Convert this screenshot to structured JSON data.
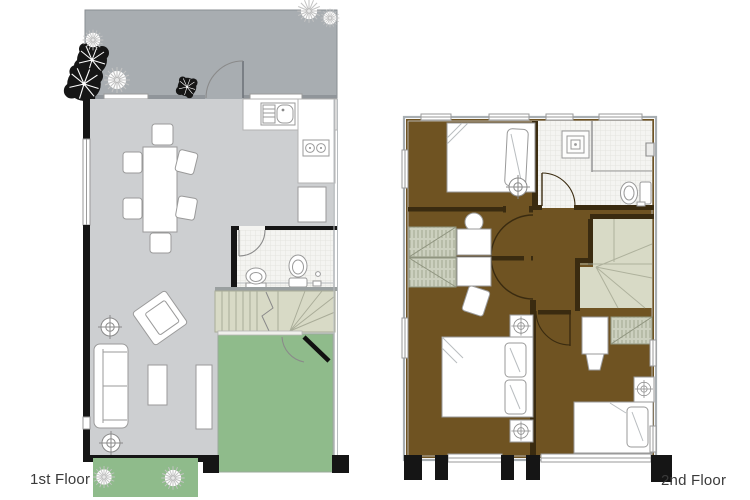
{
  "labels": {
    "floor1": "1st Floor",
    "floor2": "2nd Floor"
  },
  "colors": {
    "patio": "#a8adb1",
    "living_floor": "#cdcfd1",
    "garden_green": "#8fbb8b",
    "wood_brown": "#6f5322",
    "stair_beige": "#d8dac6",
    "wardrobe_beige": "#ccd0bf",
    "bath_tile": "#f4f4f1",
    "wall_black": "#151515",
    "wall_dark_brown": "#3a2b10",
    "line_gray": "#8a8a8a",
    "label_text": "#3a3a3a"
  }
}
